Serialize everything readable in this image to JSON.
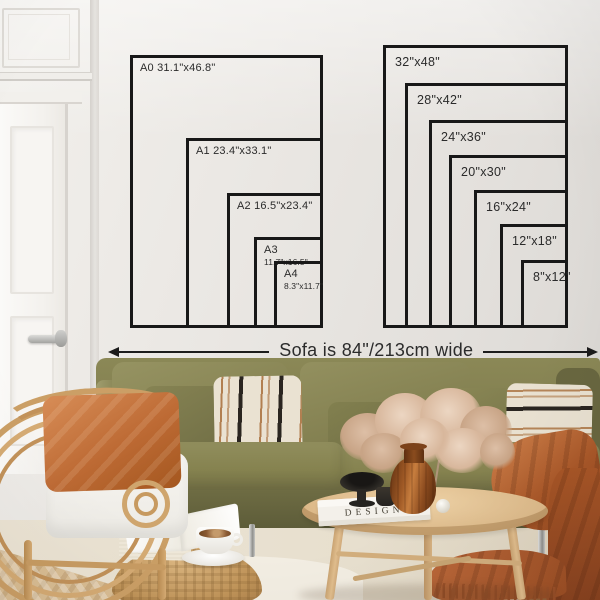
{
  "palette": {
    "wall": "#e9e6e2",
    "diagram_line": "#181818",
    "diagram_text": "#2b2b2b",
    "sofa_olive": "#827f50",
    "sofa_olive_dark": "#66643f",
    "pillow_olive_light": "#908d5d",
    "pillow_cream": "#eae2d2",
    "stripe_black": "#25211d",
    "stripe_rust": "#ad743e",
    "terracotta_pillow": "#c4723c",
    "throw_blanket": "#ab5a2c",
    "rattan": "#cb9f66",
    "pouf": "#c09459",
    "table_wood": "#ddba8a",
    "floor_wood_light": "#d9bd93",
    "floor_wood_dark": "#9c6a41",
    "rug": "#e8e0d0",
    "door_white": "#f8f6f3",
    "vase_amber": "#a05a26",
    "flowers": "#d9b9a2",
    "chrome": "#c2c2c0"
  },
  "caption": {
    "text": "Sofa is 84\"/213cm wide"
  },
  "size_diagrams": {
    "a_series": {
      "frames": [
        {
          "id": "a0",
          "label": "A0 31.1\"x46.8\"",
          "x": 130,
          "y": 55,
          "w": 193,
          "h": 273
        },
        {
          "id": "a1",
          "label": "A1 23.4\"x33.1\"",
          "x": 186,
          "y": 138,
          "w": 137,
          "h": 190
        },
        {
          "id": "a2",
          "label": "A2 16.5\"x23.4\"",
          "x": 227,
          "y": 193,
          "w": 96,
          "h": 135
        },
        {
          "id": "a3",
          "label": "A3",
          "sub": "11.7\"x16.5\"",
          "x": 254,
          "y": 237,
          "w": 69,
          "h": 91
        },
        {
          "id": "a4",
          "label": "A4",
          "sub": "8.3\"x11.7\"",
          "x": 274,
          "y": 261,
          "w": 49,
          "h": 67
        }
      ]
    },
    "inch_series": {
      "frames": [
        {
          "id": "32x48",
          "label": "32\"x48\"",
          "x": 383,
          "y": 45,
          "w": 185,
          "h": 283
        },
        {
          "id": "28x42",
          "label": "28\"x42\"",
          "x": 405,
          "y": 83,
          "w": 163,
          "h": 245
        },
        {
          "id": "24x36",
          "label": "24\"x36\"",
          "x": 429,
          "y": 120,
          "w": 139,
          "h": 208
        },
        {
          "id": "20x30",
          "label": "20\"x30\"",
          "x": 449,
          "y": 155,
          "w": 119,
          "h": 173
        },
        {
          "id": "16x24",
          "label": "16\"x24\"",
          "x": 474,
          "y": 190,
          "w": 94,
          "h": 138
        },
        {
          "id": "12x18",
          "label": "12\"x18\"",
          "x": 500,
          "y": 224,
          "w": 68,
          "h": 104
        },
        {
          "id": "8x12",
          "label": "8\"x12\"",
          "x": 521,
          "y": 260,
          "w": 47,
          "h": 68
        }
      ]
    }
  },
  "decor": {
    "book_title": "DESIGN"
  }
}
